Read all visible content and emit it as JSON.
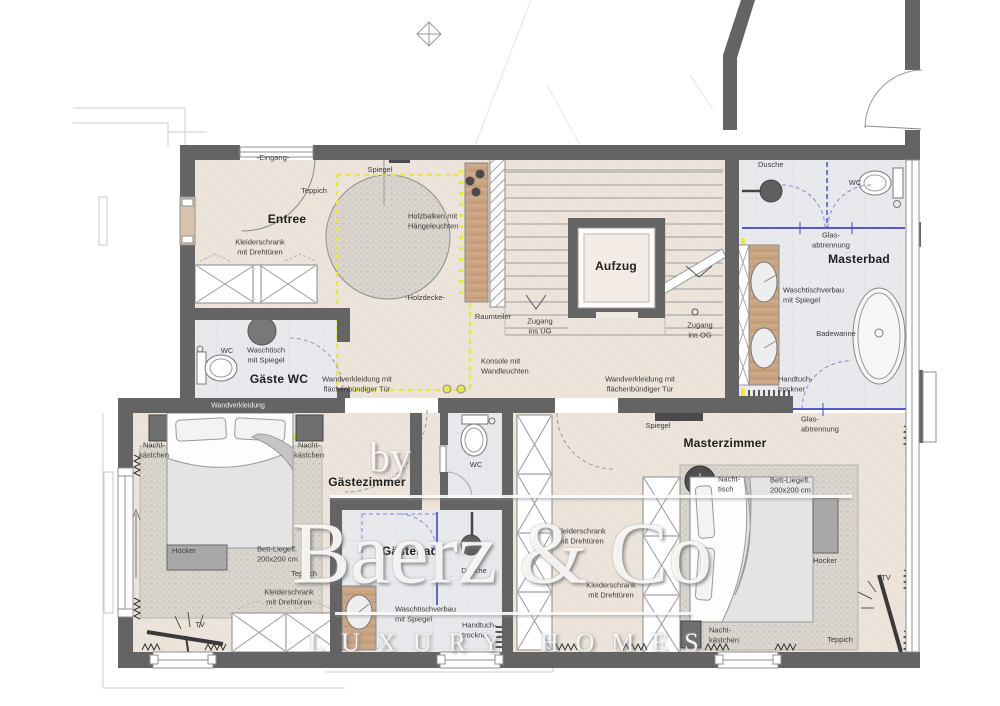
{
  "watermark": {
    "by": "by",
    "brand": "Baerz & Co",
    "tagline": "LUXURY HOMES"
  },
  "rooms": {
    "entree": "Entree",
    "gaeste_wc": "Gäste WC",
    "gaestezimmer": "Gästezimmer",
    "gaestebad": "Gästebad",
    "masterbad": "Masterbad",
    "masterzimmer": "Masterzimmer",
    "aufzug": "Aufzug"
  },
  "labels": {
    "eingang": "-Eingang-",
    "spiegel": "Spiegel",
    "teppich": "Teppich",
    "kleiderschrank": "Kleiderschrank\nmit Drehtüren",
    "holzbalken": "Holzbalken mit\nHängeleuchten",
    "holzdecke": "-Holzdecke-",
    "raumteiler": "Raumteiler",
    "konsole": "Konsole mit\nWandleuchten",
    "zugang_ug": "Zugang\nins UG",
    "zugang_og": "Zugang\nins OG",
    "wandverkleidung_tuer": "Wandverkleidung mit\nflächenbündiger Tür",
    "wandverkleidung": "Wandverkleidung",
    "wc": "WC",
    "waschtisch": "Waschtisch\nmit Spiegel",
    "dusche": "Dusche",
    "glasabtrennung": "Glas-\nabtrennung",
    "waschtischverbau": "Waschtischverbau\nmit Spiegel",
    "badewanne": "Badewanne",
    "handtuchtrockner": "Handtuch-\ntrockner",
    "nachtkaestchen": "Nacht-\nkästchen",
    "nachttisch": "Nacht-\ntisch",
    "bett": "Bett-Liegefl.\n200x200 cm",
    "hocker": "Hocker",
    "tv": "TV"
  },
  "colors": {
    "wall": "#646464",
    "floor_beige": "#ece3da",
    "floor_bath": "#e8e9ec",
    "carpet": "#d8d4cc",
    "wood": "#c9a584",
    "accent_yellow": "#e9e54d",
    "glass_blue": "#4343c8"
  }
}
